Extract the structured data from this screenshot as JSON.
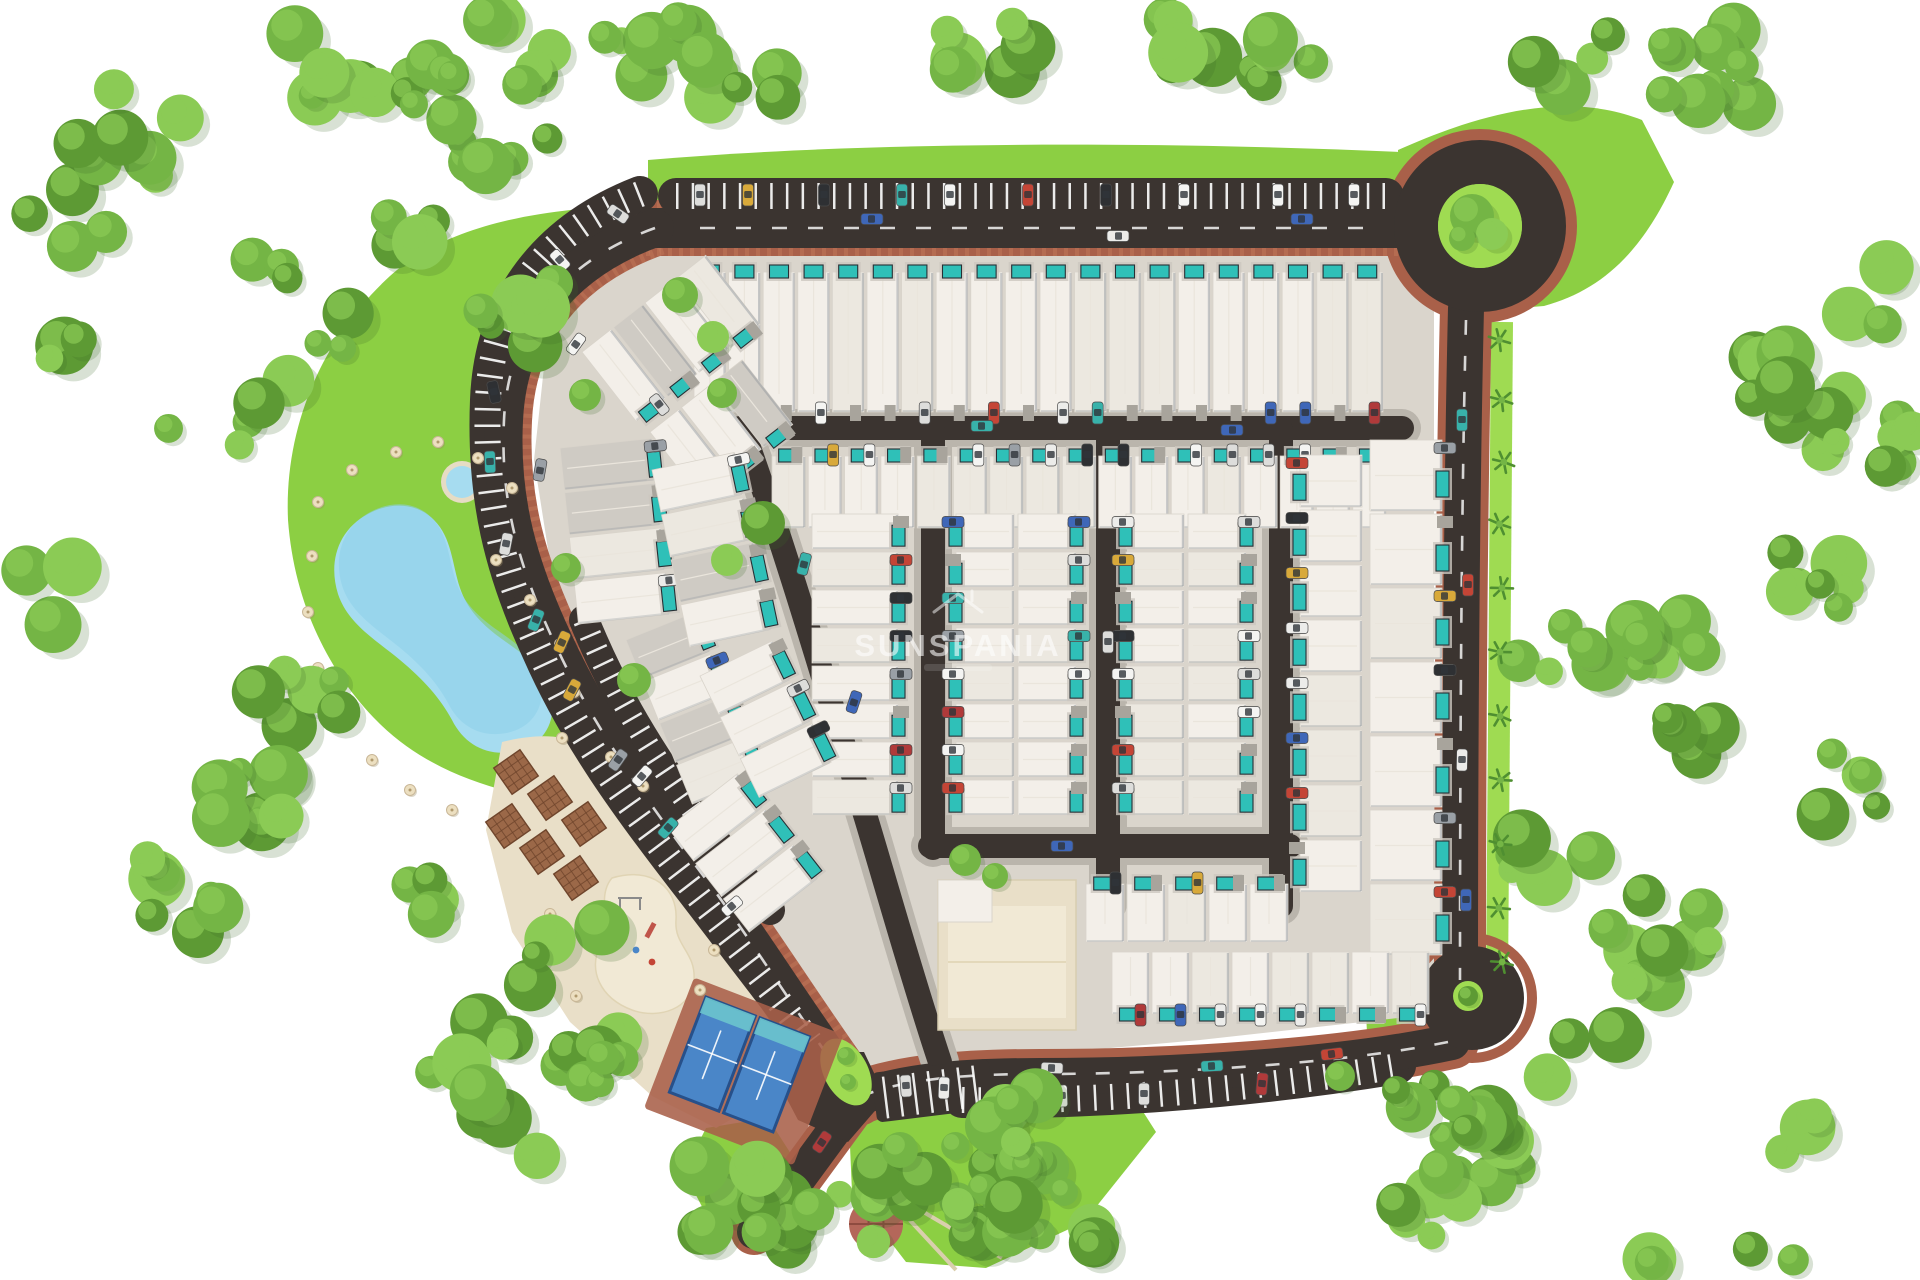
{
  "watermark": {
    "brand": "SUNSPANIA"
  },
  "colors": {
    "background": "#ffffff",
    "lawn": "#8ccf43",
    "lawn_light": "#9fdb52",
    "forest_dark": "#5d9a34",
    "forest_mid": "#74b545",
    "forest_light": "#8bcb55",
    "forest_shadow": "#3e6b26",
    "road": "#3b3430",
    "concrete": "#bab5ac",
    "ground": "#dad5cc",
    "sidewalk_brick": "#a96049",
    "sidewalk_brick_light": "#c77f5f",
    "house": "#f3efe9",
    "house_alt": "#ece8e0",
    "roof_gray": "#cfcbc4",
    "shadow": "#8f959b",
    "pool": "#2fc0b8",
    "pool_deck": "#ccc7bf",
    "lagoon": "#a6dcf0",
    "lagoon_deep": "#8ccfe9",
    "sand": "#e9dfc8",
    "sand_light": "#f1e9d5",
    "pergola": "#9b6848",
    "pergola_dark": "#6f452c",
    "court": "#4a86c8",
    "court_band": "#6cc4cd",
    "court_edge": "#27508a",
    "kiosk_roof": "#b4675a",
    "kiosk_body": "#e3ded2",
    "marking": "#ffffff",
    "palm": "#4f8f31"
  },
  "vehicle_colors": [
    "#f4f4f2",
    "#ececea",
    "#dddddb",
    "#c44536",
    "#b03a3a",
    "#3f67b8",
    "#2e3033",
    "#d8a93a",
    "#38b2aa",
    "#9aa0a6"
  ],
  "features": {
    "amenities": [
      "perimeter-road",
      "roundabout",
      "palm-lined-avenue",
      "street-parking",
      "terraced-houses",
      "private-pools",
      "lagoon-pool",
      "kids-pool",
      "sun-umbrellas",
      "beach-plaza",
      "pergolas",
      "playground",
      "padel-courts",
      "gazebo",
      "green-areas",
      "forest-belt"
    ]
  }
}
